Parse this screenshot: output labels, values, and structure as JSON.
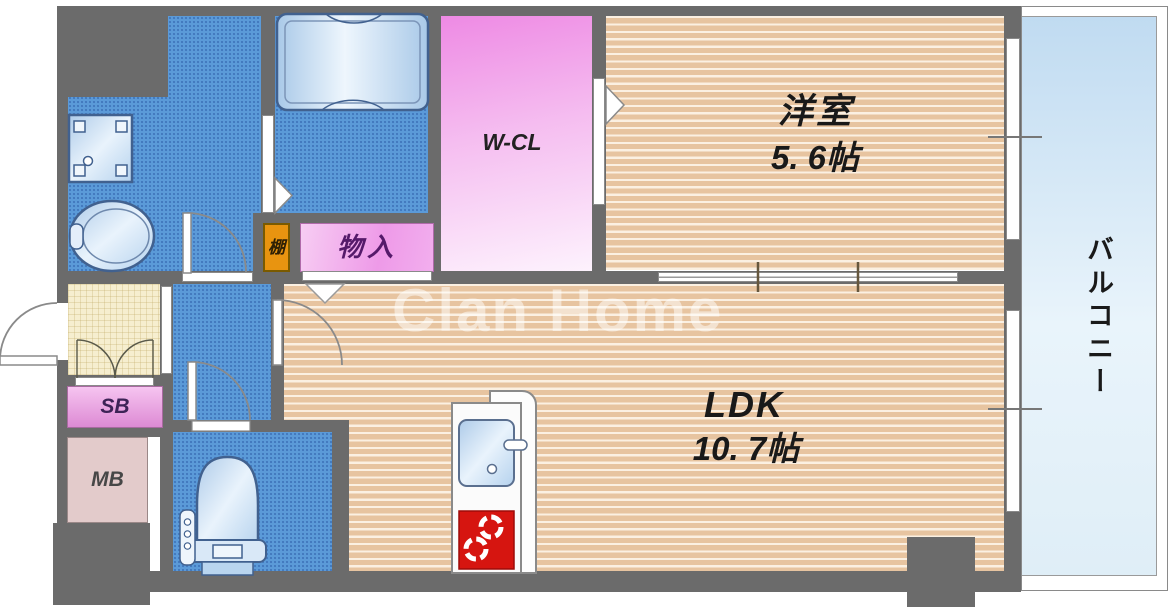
{
  "watermark": "Clan Home",
  "rooms": {
    "western": {
      "name": "洋室",
      "size": "5. 6帖"
    },
    "ldk": {
      "name": "LDK",
      "size": "10. 7帖"
    },
    "wcl": {
      "label": "W-CL"
    },
    "storage": {
      "label": "物入"
    },
    "shelf": {
      "label": "棚"
    },
    "shoebox": {
      "label": "SB"
    },
    "meterbox": {
      "label": "MB"
    },
    "balcony": {
      "label": "バルコニー"
    }
  },
  "colors": {
    "wall": "#6b6b6b",
    "water_area_blue": "#5b9ad8",
    "wood_floor_tan": "#e7c4a0",
    "closet_pink": "#ee8ae4",
    "shelf_orange": "#e89410",
    "stove_red": "#d61510",
    "balcony_blue": "#c0dbf1",
    "entrance_cream": "#f6eecf"
  }
}
